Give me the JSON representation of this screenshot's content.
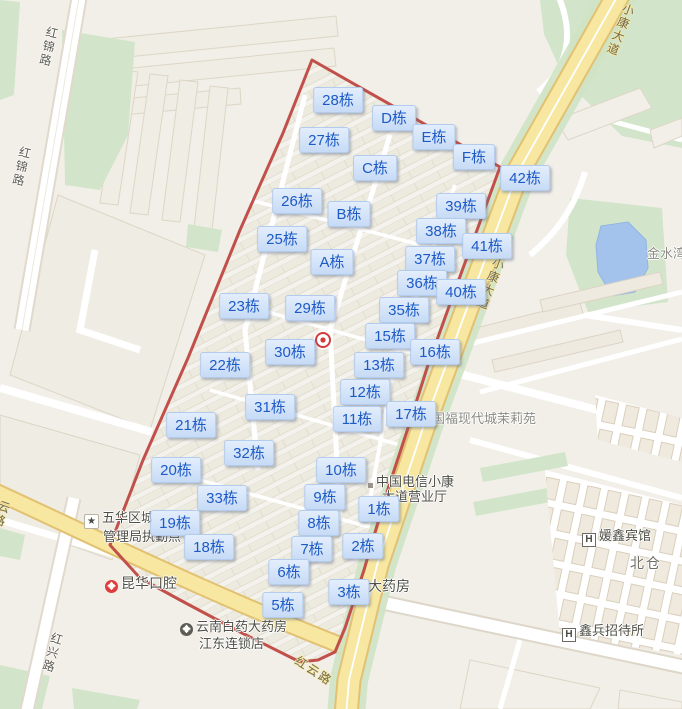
{
  "colors": {
    "label_bg": "#cfe0f8",
    "label_text": "#1d5ac6",
    "boundary_red": "#c1504b",
    "road_yellow": "#f8e9a1",
    "water_blue": "#a3c3ec",
    "green": "#d2e5ca",
    "bg": "#f2efe9"
  },
  "building_labels": [
    {
      "label": "28栋",
      "x": 338,
      "y": 100
    },
    {
      "label": "D栋",
      "x": 394,
      "y": 118
    },
    {
      "label": "27栋",
      "x": 324,
      "y": 140
    },
    {
      "label": "E栋",
      "x": 434,
      "y": 137
    },
    {
      "label": "F栋",
      "x": 474,
      "y": 157
    },
    {
      "label": "C栋",
      "x": 375,
      "y": 168
    },
    {
      "label": "42栋",
      "x": 525,
      "y": 178
    },
    {
      "label": "26栋",
      "x": 297,
      "y": 201
    },
    {
      "label": "39栋",
      "x": 461,
      "y": 206
    },
    {
      "label": "B栋",
      "x": 349,
      "y": 214
    },
    {
      "label": "38栋",
      "x": 441,
      "y": 231
    },
    {
      "label": "25栋",
      "x": 282,
      "y": 239
    },
    {
      "label": "41栋",
      "x": 487,
      "y": 246
    },
    {
      "label": "A栋",
      "x": 332,
      "y": 262
    },
    {
      "label": "37栋",
      "x": 430,
      "y": 259
    },
    {
      "label": "36栋",
      "x": 422,
      "y": 283
    },
    {
      "label": "40栋",
      "x": 461,
      "y": 292
    },
    {
      "label": "23栋",
      "x": 244,
      "y": 306
    },
    {
      "label": "29栋",
      "x": 310,
      "y": 308
    },
    {
      "label": "35栋",
      "x": 404,
      "y": 310
    },
    {
      "label": "15栋",
      "x": 390,
      "y": 336
    },
    {
      "label": "30栋",
      "x": 290,
      "y": 352
    },
    {
      "label": "16栋",
      "x": 435,
      "y": 352
    },
    {
      "label": "22栋",
      "x": 225,
      "y": 365
    },
    {
      "label": "13栋",
      "x": 379,
      "y": 365
    },
    {
      "label": "12栋",
      "x": 365,
      "y": 392
    },
    {
      "label": "31栋",
      "x": 270,
      "y": 407
    },
    {
      "label": "17栋",
      "x": 411,
      "y": 414
    },
    {
      "label": "11栋",
      "x": 357,
      "y": 419
    },
    {
      "label": "21栋",
      "x": 191,
      "y": 425
    },
    {
      "label": "32栋",
      "x": 249,
      "y": 453
    },
    {
      "label": "20栋",
      "x": 176,
      "y": 470
    },
    {
      "label": "10栋",
      "x": 341,
      "y": 470
    },
    {
      "label": "33栋",
      "x": 222,
      "y": 498
    },
    {
      "label": "9栋",
      "x": 325,
      "y": 497
    },
    {
      "label": "1栋",
      "x": 379,
      "y": 509
    },
    {
      "label": "19栋",
      "x": 175,
      "y": 523
    },
    {
      "label": "8栋",
      "x": 319,
      "y": 523
    },
    {
      "label": "18栋",
      "x": 209,
      "y": 547
    },
    {
      "label": "7栋",
      "x": 312,
      "y": 549
    },
    {
      "label": "2栋",
      "x": 363,
      "y": 546
    },
    {
      "label": "6栋",
      "x": 289,
      "y": 572
    },
    {
      "label": "3栋",
      "x": 349,
      "y": 592
    },
    {
      "label": "5栋",
      "x": 283,
      "y": 605
    }
  ],
  "poi": {
    "chengguan_line1": "五华区城",
    "chengguan_line2": "管理局执勤点",
    "kunhua": "昆华口腔",
    "baiyao_line1": "云南白药大药房",
    "baiyao_line2": "江东连锁店",
    "pharmacy": "大药房",
    "telecom_line1": "中国电信小康",
    "telecom_line2": "大道营业厅",
    "jinshuiwan": "金水湾",
    "guofu": "国福现代城茉莉苑",
    "yuanxin": "媛鑫宾馆",
    "beicang": "北仓",
    "xinbing": "鑫兵招待所"
  },
  "roads": {
    "hongjin": "红锦路",
    "hongxing": "红兴路",
    "xiaokang": "小康大道",
    "hongyun": "红云路",
    "partial_left": "云路"
  },
  "icons": {
    "hotel_glyph": "H",
    "star_glyph": "★",
    "cross_glyph": "+",
    "names": [
      "location-target-icon",
      "star-badge-icon",
      "red-cross-icon",
      "pharmacy-cross-icon",
      "hotel-h-icon",
      "poi-dot-icon"
    ]
  }
}
